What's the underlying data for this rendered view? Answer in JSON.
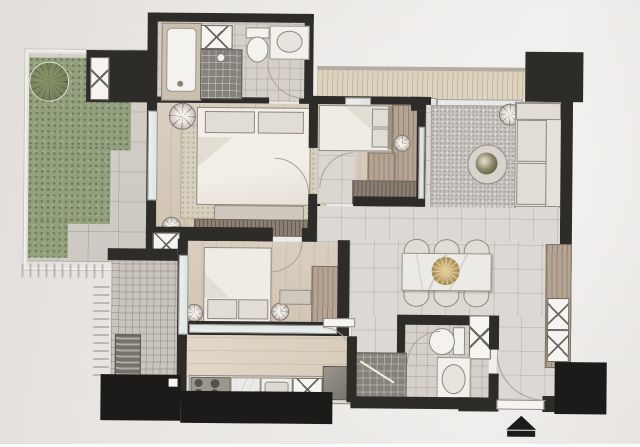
{
  "meta": {
    "kind": "floor-plan-photo",
    "description": "Photograph of a printed condominium floor plan, no text labels, slightly tilted on warm grey paper",
    "orientation_symbol": "north-arrow-bottom-right"
  },
  "palette": {
    "paper": "#e9e6e3",
    "wall": "#2e2c29",
    "wallDark": "#1c1b19",
    "woodFloor": "#d9cec0",
    "tileFloor": "#dcd8d3",
    "bathTile": "#d6d0ca",
    "terraceTile": "#cdc9c2",
    "balconyDeck": "#ded3bf",
    "hedgeGreen": "#93a07e",
    "treeGreen": "#77855e",
    "rugGrey": "#c9c4bf",
    "rugBeige": "#d7d0bf",
    "furnitureWood": "#b5a493",
    "furnitureDark": "#8a7f72",
    "fabricWhite": "#efece5",
    "marble": "#eceae6",
    "gold": "#b59a63",
    "showerTile": "#85817b",
    "appliance": "#75716b"
  },
  "rooms": [
    {
      "id": "garden-terrace",
      "features": [
        "l-shaped-hedge",
        "round-tree",
        "large-floor-tiles",
        "survey-tick-marks"
      ]
    },
    {
      "id": "master-bathroom",
      "features": [
        "bathtub",
        "shower",
        "toilet",
        "sink-vanity",
        "duct-shaft-x"
      ]
    },
    {
      "id": "master-bedroom",
      "features": [
        "double-bed",
        "2-pillows",
        "area-rug",
        "2-nightstand-lamps",
        "foot-bench",
        "tv-console",
        "window-wall"
      ]
    },
    {
      "id": "bedroom-2",
      "features": [
        "single-bed",
        "2-pillows",
        "wood-wardrobe",
        "ceiling-lamp",
        "dresser",
        "door-swing"
      ]
    },
    {
      "id": "living-room",
      "features": [
        "speckled-rug",
        "sofa-2-seat",
        "round-coffee-table-with-plant",
        "floor-lamp"
      ]
    },
    {
      "id": "dining-area",
      "features": [
        "marble-dining-table",
        "6-chairs",
        "gold-centerpiece"
      ]
    },
    {
      "id": "kitchen",
      "features": [
        "counter-run",
        "4-burner-stove",
        "sink",
        "x-cabinet",
        "refrigerator",
        "door-swing"
      ]
    },
    {
      "id": "bathroom-2",
      "features": [
        "toilet",
        "sink-vanity",
        "dark-tile-shower",
        "duct-shaft-x",
        "door-swing"
      ]
    },
    {
      "id": "bedroom-3",
      "features": [
        "double-bed",
        "2-pillows",
        "2-lamps",
        "desk",
        "wardrobe",
        "window-strip"
      ]
    },
    {
      "id": "balcony-top",
      "features": [
        "deck-hatch",
        "sliding-doors"
      ]
    },
    {
      "id": "balcony-2",
      "features": [
        "cross-hatch-deck",
        "ac-unit",
        "glass-door"
      ]
    },
    {
      "id": "entrance-hall",
      "features": [
        "entry-door-swing",
        "tall-x-cabinet",
        "structural-column"
      ]
    }
  ],
  "counts": {
    "dining_chairs": 6,
    "stove_burners": 4,
    "shaft_x_boxes": 4,
    "black_columns": 4,
    "door_swings": 7
  },
  "symbols": {
    "north_arrow": "black triangle over bar, pointing up",
    "shaft": "white box with X",
    "door": "quarter-circle swing arc"
  }
}
